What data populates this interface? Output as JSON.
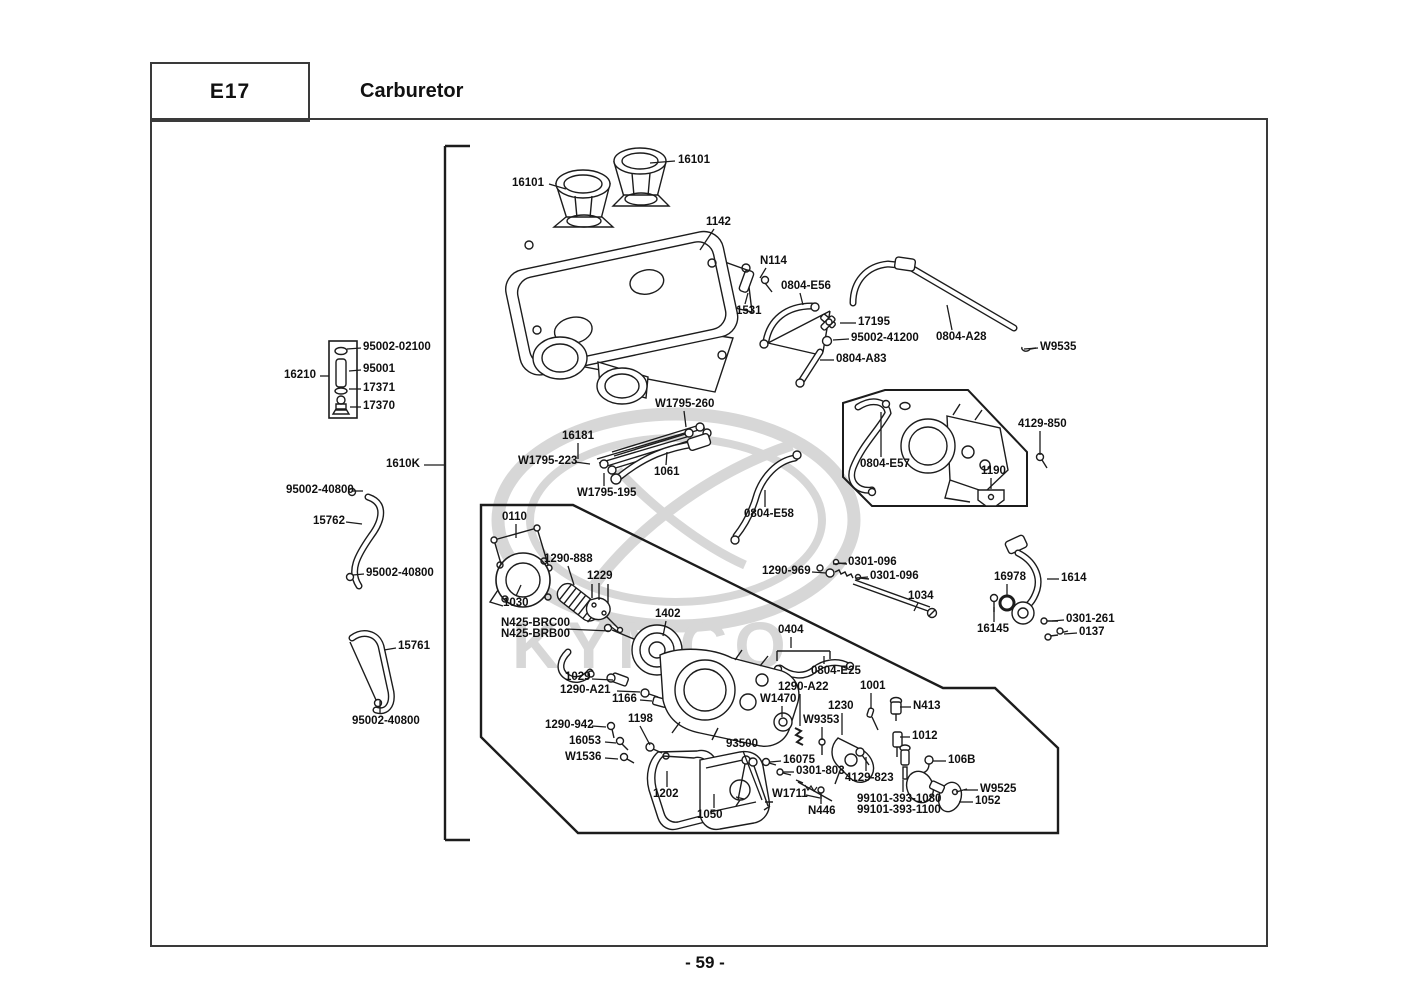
{
  "header": {
    "code": "E17",
    "title": "Carburetor"
  },
  "footer": {
    "page_number": "- 59 -"
  },
  "watermark": {
    "text": "KYMCO",
    "color": "#d7d7d7"
  },
  "colors": {
    "line": "#1c1c1c",
    "border": "#3a3a3a",
    "label": "#101010"
  },
  "diagram": {
    "labels": [
      {
        "t": "16101",
        "x": 512,
        "y": 178,
        "l": [
          549,
          184,
          566,
          189
        ]
      },
      {
        "t": "16101",
        "x": 678,
        "y": 155,
        "l": [
          675,
          161,
          650,
          163
        ]
      },
      {
        "t": "1142",
        "x": 706,
        "y": 217,
        "l": [
          714,
          229,
          700,
          250
        ]
      },
      {
        "t": "N114",
        "x": 760,
        "y": 256,
        "l": [
          766,
          268,
          760,
          278
        ]
      },
      {
        "t": "0804-E56",
        "x": 781,
        "y": 281,
        "l": [
          800,
          293,
          803,
          305
        ]
      },
      {
        "t": "1531",
        "x": 736,
        "y": 306,
        "l": [
          745,
          304,
          748,
          293
        ]
      },
      {
        "t": "17195",
        "x": 858,
        "y": 317,
        "l": [
          856,
          323,
          840,
          323
        ]
      },
      {
        "t": "95002-41200",
        "x": 851,
        "y": 333,
        "l": [
          849,
          339,
          833,
          340
        ]
      },
      {
        "t": "0804-A28",
        "x": 936,
        "y": 332,
        "l": [
          952,
          330,
          947,
          305
        ]
      },
      {
        "t": "W9535",
        "x": 1040,
        "y": 342,
        "l": [
          1038,
          348,
          1024,
          349
        ]
      },
      {
        "t": "0804-A83",
        "x": 836,
        "y": 354,
        "l": [
          834,
          360,
          820,
          360
        ]
      },
      {
        "t": "95002-02100",
        "x": 363,
        "y": 342,
        "l": [
          361,
          348,
          347,
          349
        ]
      },
      {
        "t": "95001",
        "x": 363,
        "y": 364,
        "l": [
          361,
          370,
          349,
          371
        ]
      },
      {
        "t": "17371",
        "x": 363,
        "y": 383,
        "l": [
          361,
          389,
          349,
          389
        ]
      },
      {
        "t": "17370",
        "x": 363,
        "y": 401,
        "l": [
          361,
          407,
          350,
          407
        ]
      },
      {
        "t": "16210",
        "x": 284,
        "y": 370,
        "l": [
          320,
          376,
          329,
          376
        ]
      },
      {
        "t": "W1795-260",
        "x": 655,
        "y": 399,
        "l": [
          684,
          411,
          686,
          427
        ]
      },
      {
        "t": "16181",
        "x": 562,
        "y": 431,
        "l": [
          578,
          443,
          578,
          459
        ]
      },
      {
        "t": "W1795-223",
        "x": 518,
        "y": 456,
        "l": [
          575,
          462,
          590,
          464
        ]
      },
      {
        "t": "1061",
        "x": 654,
        "y": 467,
        "l": [
          666,
          465,
          667,
          452
        ]
      },
      {
        "t": "W1795-195",
        "x": 577,
        "y": 488,
        "l": [
          604,
          486,
          604,
          473
        ]
      },
      {
        "t": "0804-E57",
        "x": 860,
        "y": 459,
        "l": [
          881,
          457,
          881,
          412
        ]
      },
      {
        "t": "4129-850",
        "x": 1018,
        "y": 419,
        "l": [
          1040,
          431,
          1040,
          455
        ]
      },
      {
        "t": "1190",
        "x": 981,
        "y": 466,
        "l": [
          991,
          478,
          991,
          489
        ]
      },
      {
        "t": "1610K",
        "x": 386,
        "y": 459,
        "l": [
          424,
          465,
          444,
          465
        ]
      },
      {
        "t": "95002-40800",
        "x": 286,
        "y": 485,
        "l": [
          352,
          491,
          363,
          491
        ]
      },
      {
        "t": "15762",
        "x": 313,
        "y": 516,
        "l": [
          346,
          522,
          362,
          524
        ]
      },
      {
        "t": "95002-40800",
        "x": 366,
        "y": 568,
        "l": [
          364,
          574,
          353,
          575
        ]
      },
      {
        "t": "0110",
        "x": 502,
        "y": 512,
        "l": [
          516,
          524,
          516,
          538
        ]
      },
      {
        "t": "1290-888",
        "x": 544,
        "y": 554,
        "l": [
          568,
          566,
          574,
          585
        ]
      },
      {
        "t": "1229",
        "x": 587,
        "y": 571,
        "l": [
          599,
          583,
          599,
          600
        ]
      },
      {
        "t": "0804-E58",
        "x": 744,
        "y": 509,
        "l": [
          765,
          507,
          765,
          490
        ]
      },
      {
        "t": "1290-969",
        "x": 762,
        "y": 566,
        "l": [
          812,
          572,
          826,
          573
        ]
      },
      {
        "t": "0301-096",
        "x": 848,
        "y": 557,
        "l": [
          846,
          563,
          833,
          564
        ]
      },
      {
        "t": "0301-096",
        "x": 870,
        "y": 571,
        "l": [
          868,
          577,
          856,
          578
        ]
      },
      {
        "t": "1034",
        "x": 908,
        "y": 591,
        "l": [
          918,
          603,
          914,
          611
        ]
      },
      {
        "t": "16978",
        "x": 994,
        "y": 572,
        "l": [
          1007,
          584,
          1007,
          596
        ]
      },
      {
        "t": "1614",
        "x": 1061,
        "y": 573,
        "l": [
          1059,
          579,
          1047,
          579
        ]
      },
      {
        "t": "16145",
        "x": 977,
        "y": 624,
        "l": [
          994,
          622,
          994,
          607
        ]
      },
      {
        "t": "0301-261",
        "x": 1066,
        "y": 614,
        "l": [
          1064,
          620,
          1052,
          621
        ]
      },
      {
        "t": "0137",
        "x": 1079,
        "y": 627,
        "l": [
          1077,
          633,
          1064,
          634
        ]
      },
      {
        "t": "15761",
        "x": 398,
        "y": 641,
        "l": [
          396,
          648,
          384,
          650
        ]
      },
      {
        "t": "95002-40800",
        "x": 352,
        "y": 716,
        "l": [
          380,
          714,
          380,
          701
        ]
      },
      {
        "t": "1029",
        "x": 565,
        "y": 672,
        "l": [
          592,
          679,
          613,
          680
        ]
      },
      {
        "t": "1290-A21",
        "x": 560,
        "y": 685,
        "l": [
          617,
          691,
          640,
          692
        ]
      },
      {
        "t": "1166",
        "x": 612,
        "y": 694,
        "l": [
          640,
          700,
          652,
          701
        ]
      },
      {
        "t": "1198",
        "x": 628,
        "y": 714,
        "l": [
          640,
          726,
          650,
          745
        ]
      },
      {
        "t": "1290-942",
        "x": 545,
        "y": 720,
        "l": [
          592,
          726,
          606,
          727
        ]
      },
      {
        "t": "16053",
        "x": 569,
        "y": 736,
        "l": [
          605,
          742,
          616,
          743
        ]
      },
      {
        "t": "W1536",
        "x": 565,
        "y": 752,
        "l": [
          605,
          758,
          618,
          759
        ]
      },
      {
        "t": "93500",
        "x": 726,
        "y": 739,
        "l": [
          743,
          751,
          762,
          800
        ]
      },
      {
        "t": "16075",
        "x": 783,
        "y": 755,
        "l": [
          781,
          761,
          770,
          762
        ]
      },
      {
        "t": "0301-803",
        "x": 796,
        "y": 766,
        "l": [
          794,
          772,
          783,
          772
        ]
      },
      {
        "t": "4129-823",
        "x": 845,
        "y": 773,
        "l": [
          866,
          771,
          866,
          757
        ]
      },
      {
        "t": "W1711",
        "x": 772,
        "y": 789,
        "l": [
          806,
          795,
          820,
          798
        ]
      },
      {
        "t": "N446",
        "x": 808,
        "y": 806,
        "l": [
          821,
          804,
          821,
          794
        ]
      },
      {
        "t": "1202",
        "x": 653,
        "y": 789,
        "l": [
          667,
          787,
          667,
          771
        ]
      },
      {
        "t": "1050",
        "x": 697,
        "y": 810,
        "l": [
          714,
          808,
          714,
          794
        ]
      },
      {
        "t": "99101-393-1080",
        "x": 857,
        "y": 794,
        "l": [
          903,
          792,
          903,
          780
        ]
      },
      {
        "t": "99101-393-1100",
        "x": 857,
        "y": 805
      },
      {
        "t": "106B",
        "x": 948,
        "y": 755,
        "l": [
          946,
          761,
          933,
          761
        ]
      },
      {
        "t": "W9525",
        "x": 980,
        "y": 784,
        "l": [
          978,
          790,
          964,
          790
        ]
      },
      {
        "t": "1052",
        "x": 975,
        "y": 796,
        "l": [
          973,
          802,
          959,
          802
        ]
      },
      {
        "t": "1001",
        "x": 860,
        "y": 681,
        "l": [
          871,
          693,
          871,
          709
        ]
      },
      {
        "t": "N413",
        "x": 913,
        "y": 701,
        "l": [
          911,
          707,
          900,
          707
        ]
      },
      {
        "t": "1012",
        "x": 912,
        "y": 731,
        "l": [
          910,
          737,
          900,
          737
        ]
      },
      {
        "t": "1230",
        "x": 828,
        "y": 701,
        "l": [
          842,
          713,
          842,
          735
        ]
      },
      {
        "t": "W9353",
        "x": 803,
        "y": 715,
        "l": [
          822,
          727,
          822,
          740
        ]
      },
      {
        "t": "W1470",
        "x": 760,
        "y": 694,
        "l": [
          782,
          706,
          782,
          717
        ]
      },
      {
        "t": "1290-A22",
        "x": 778,
        "y": 682,
        "l": [
          800,
          694,
          800,
          726
        ]
      },
      {
        "t": "0404",
        "x": 778,
        "y": 625,
        "l": [
          791,
          637,
          791,
          648
        ]
      },
      {
        "t": "0804-E25",
        "x": 811,
        "y": 666,
        "l": [
          824,
          664,
          824,
          656
        ]
      },
      {
        "t": "N425-BRC00",
        "x": 501,
        "y": 618,
        "l": [
          566,
          629,
          610,
          631
        ]
      },
      {
        "t": "N425-BRB00",
        "x": 501,
        "y": 629
      },
      {
        "t": "1030",
        "x": 503,
        "y": 598,
        "l": [
          516,
          596,
          521,
          585
        ]
      },
      {
        "t": "1402",
        "x": 655,
        "y": 609,
        "l": [
          666,
          621,
          663,
          636
        ]
      }
    ]
  }
}
